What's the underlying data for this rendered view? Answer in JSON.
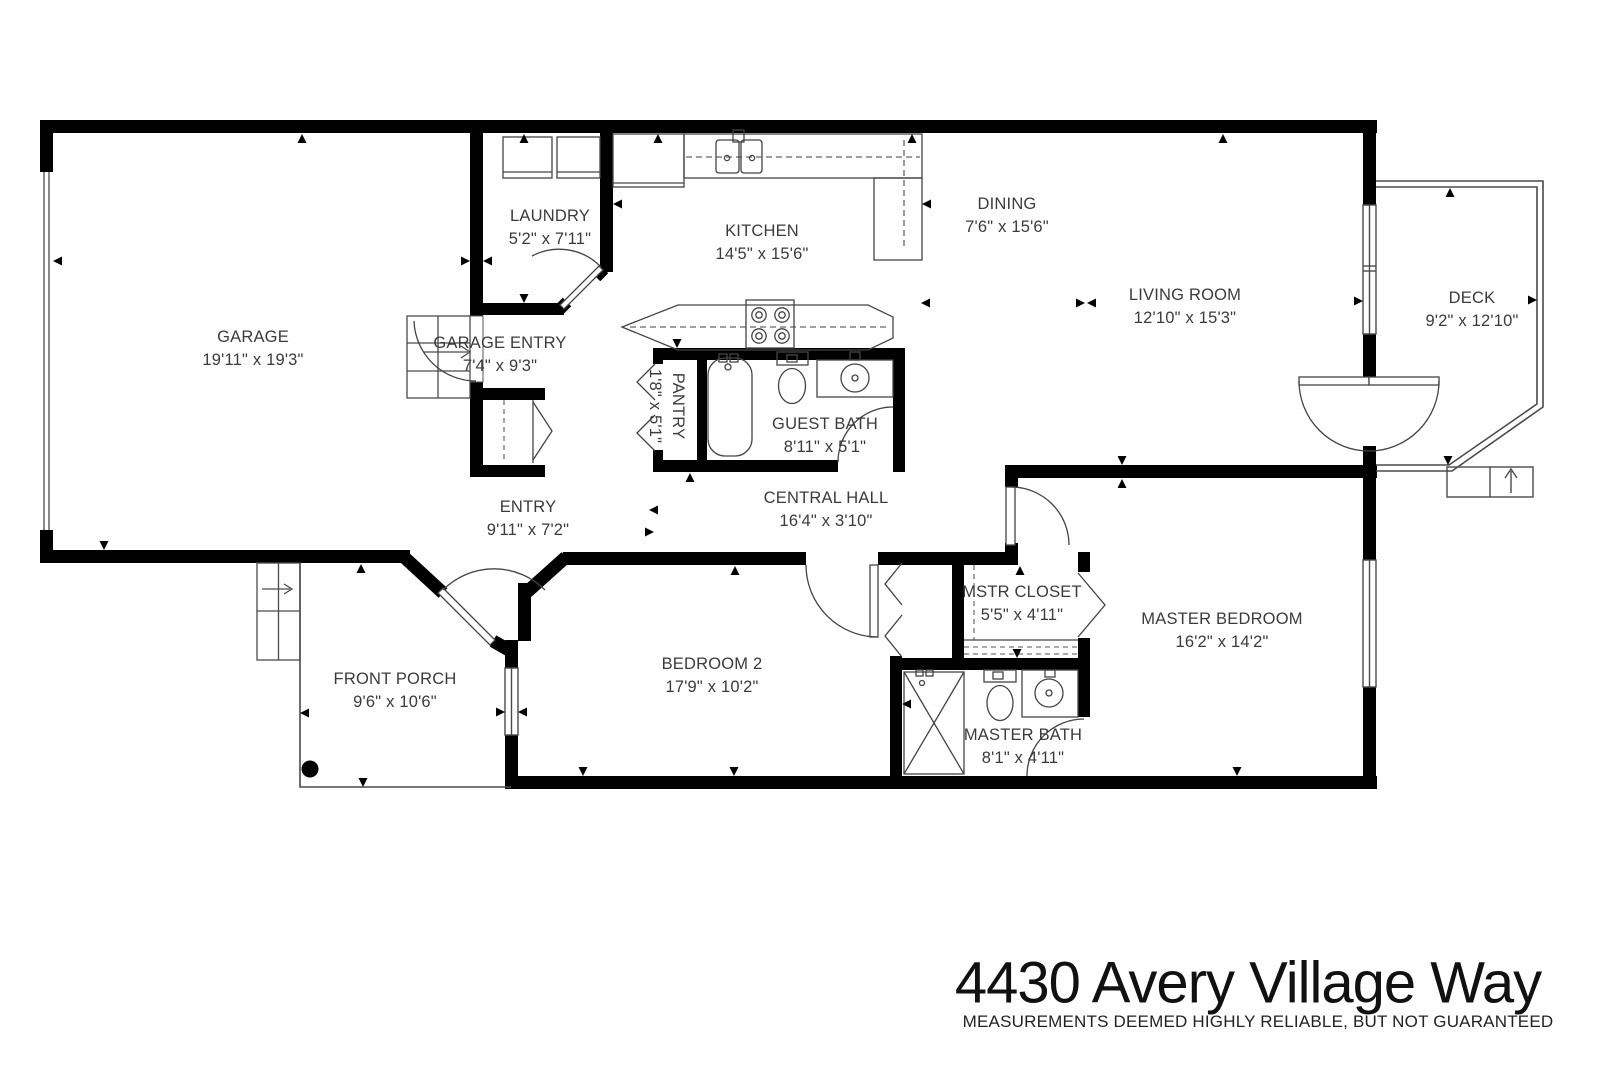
{
  "title": {
    "address": "4430 Avery Village Way",
    "disclaimer": "MEASUREMENTS DEEMED HIGHLY RELIABLE, BUT NOT GUARANTEED"
  },
  "rooms": {
    "garage": {
      "name": "GARAGE",
      "dims": "19'11\" x 19'3\""
    },
    "laundry": {
      "name": "LAUNDRY",
      "dims": "5'2\" x 7'11\""
    },
    "kitchen": {
      "name": "KITCHEN",
      "dims": "14'5\" x 15'6\""
    },
    "dining": {
      "name": "DINING",
      "dims": "7'6\" x 15'6\""
    },
    "living": {
      "name": "LIVING ROOM",
      "dims": "12'10\" x 15'3\""
    },
    "deck": {
      "name": "DECK",
      "dims": "9'2\" x 12'10\""
    },
    "garage_entry": {
      "name": "GARAGE ENTRY",
      "dims": "7'4\" x 9'3\""
    },
    "pantry": {
      "name": "PANTRY",
      "dims": "1'8\" x 5'1\""
    },
    "guest_bath": {
      "name": "GUEST BATH",
      "dims": "8'11\" x 5'1\""
    },
    "entry": {
      "name": "ENTRY",
      "dims": "9'11\" x 7'2\""
    },
    "central_hall": {
      "name": "CENTRAL HALL",
      "dims": "16'4\" x 3'10\""
    },
    "front_porch": {
      "name": "FRONT PORCH",
      "dims": "9'6\" x 10'6\""
    },
    "bedroom2": {
      "name": "BEDROOM 2",
      "dims": "17'9\" x 10'2\""
    },
    "mstr_closet": {
      "name": "MSTR CLOSET",
      "dims": "5'5\" x 4'11\""
    },
    "master_bedroom": {
      "name": "MASTER BEDROOM",
      "dims": "16'2\" x 14'2\""
    },
    "master_bath": {
      "name": "MASTER BATH",
      "dims": "8'1\" x 4'11\""
    }
  },
  "colors": {
    "wall": "#000000",
    "fixture_line": "#444444",
    "thin_line": "#4a4a4a",
    "label_text": "#3b3b3b",
    "garage_door": "#8a8a8a"
  }
}
